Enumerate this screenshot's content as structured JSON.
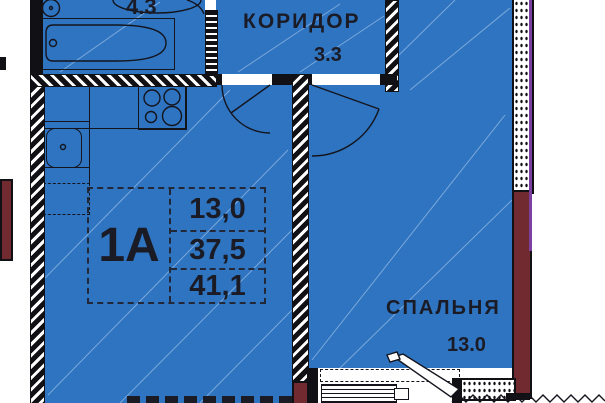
{
  "rooms": {
    "bathroom": {
      "area": "4.3"
    },
    "corridor": {
      "name": "КОРИДОР",
      "area": "3.3"
    },
    "bedroom": {
      "name": "СПАЛЬНЯ",
      "area": "13.0"
    }
  },
  "unit_card": {
    "unit": "1A",
    "values": [
      "13,0",
      "37,5",
      "41,1"
    ]
  },
  "colors": {
    "room_fill": "#2e74c1",
    "wall": "#101015",
    "pier": "#722a31",
    "outer_line": "#7b3fa0",
    "ink": "#1b1b26"
  }
}
